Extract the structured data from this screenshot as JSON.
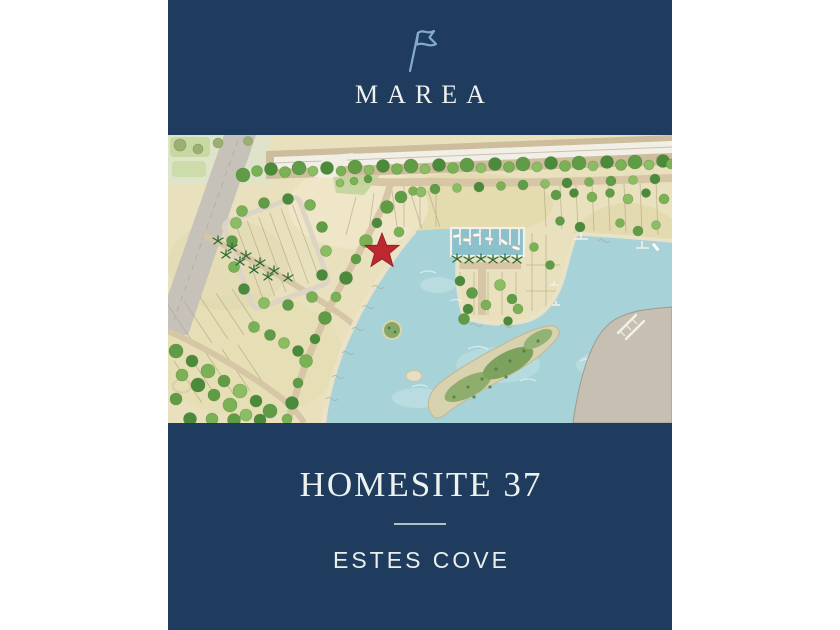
{
  "brand": {
    "name": "MAREA",
    "flag_icon": "pennant-flag-icon"
  },
  "map": {
    "alt": "Watercolor site plan of the Marea community: highway at top, residential lots and tree-lined streets, marina basin with boat docks, turquoise cove with green island, and a red star marking the homesite",
    "marker_icon": "red-star-marker"
  },
  "footer": {
    "title": "HOMESITE 37",
    "subtitle": "ESTES COVE"
  },
  "colors": {
    "navy": "#1f3b5e",
    "cream": "#eef2ef",
    "flag_blue": "#84abce",
    "star_red": "#bd2730",
    "water": "#a6d2d8",
    "marina_water": "#8cc0cb",
    "sand": "#e9e1bd",
    "beach": "#ece3c8",
    "tree_green": "#5f9c45",
    "road_tan": "#d6c6a6",
    "road_gray": "#c6c2ba",
    "island_green": "#85a76a",
    "divider": "#ccd8d4"
  }
}
